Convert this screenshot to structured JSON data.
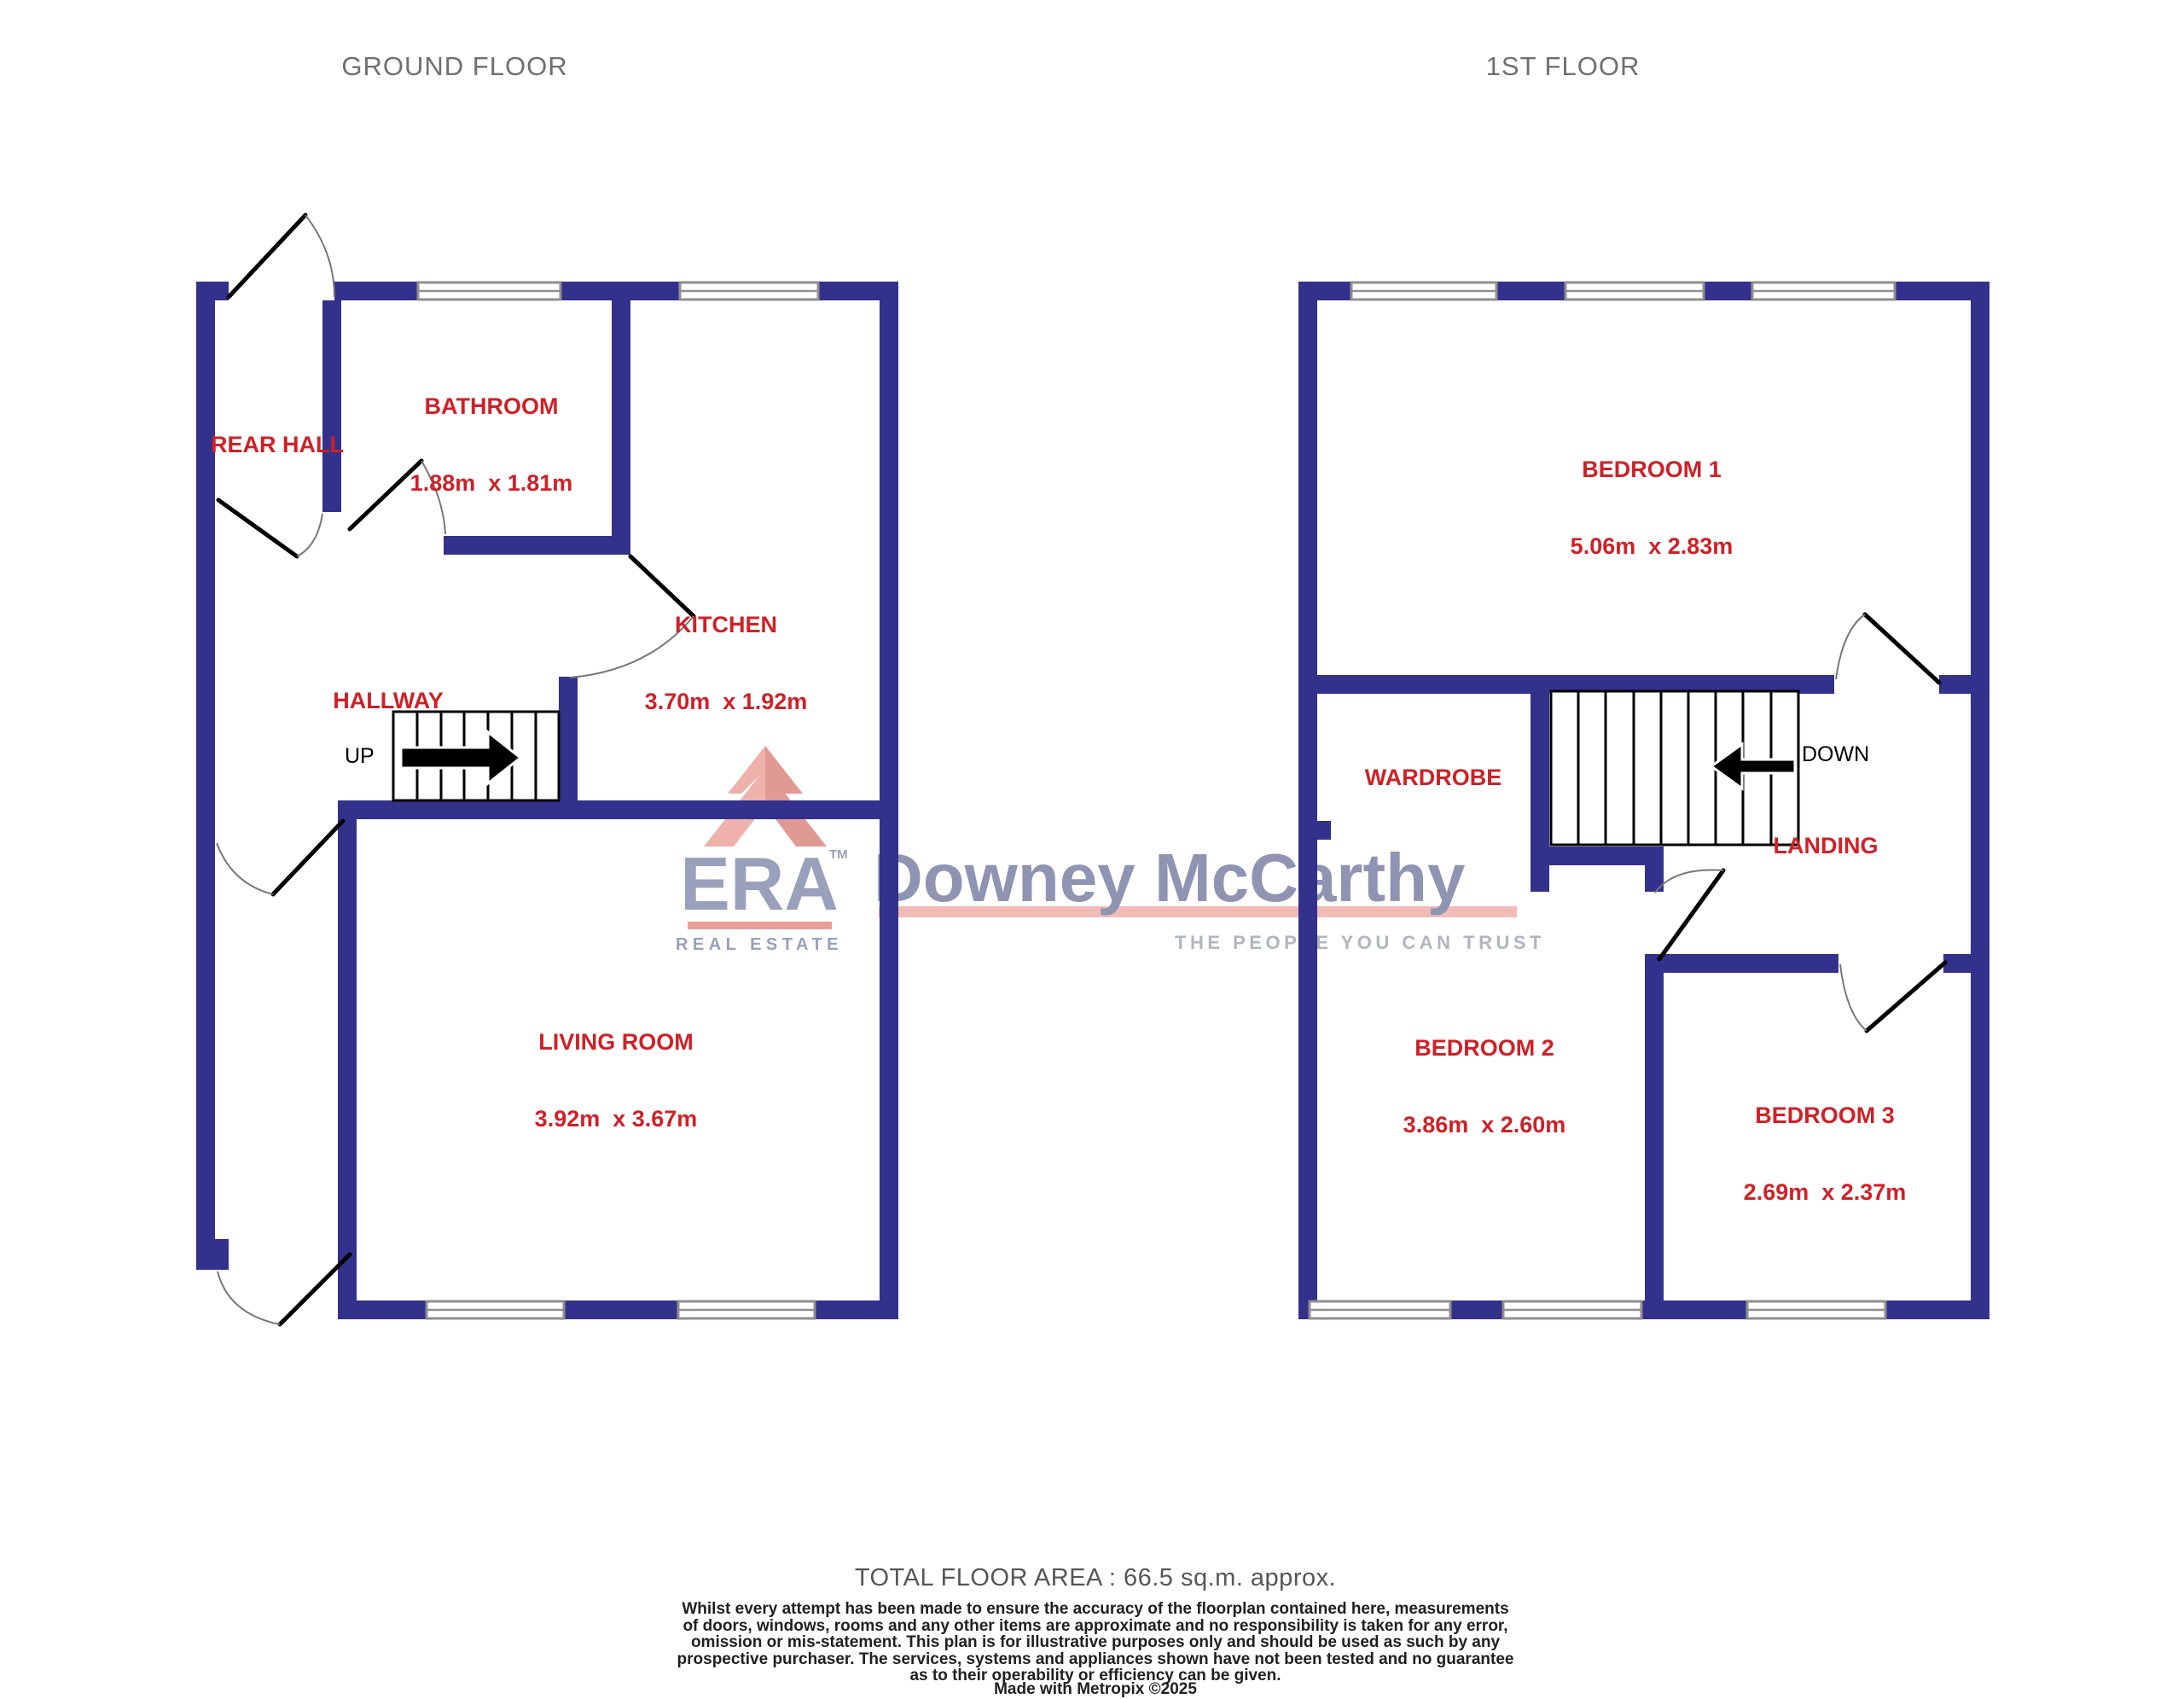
{
  "titles": {
    "ground_floor": "GROUND FLOOR",
    "first_floor": "1ST FLOOR"
  },
  "ground_floor": {
    "stairs_label": "UP",
    "rooms": [
      {
        "name": "REAR HALL",
        "dims": ""
      },
      {
        "name": "BATHROOM",
        "dims": "1.88m  x 1.81m"
      },
      {
        "name": "KITCHEN",
        "dims": "3.70m  x 1.92m"
      },
      {
        "name": "HALLWAY",
        "dims": ""
      },
      {
        "name": "LIVING ROOM",
        "dims": "3.92m  x 3.67m"
      }
    ]
  },
  "first_floor": {
    "stairs_label": "DOWN",
    "rooms": [
      {
        "name": "BEDROOM 1",
        "dims": "5.06m  x 2.83m"
      },
      {
        "name": "WARDROBE",
        "dims": ""
      },
      {
        "name": "LANDING",
        "dims": ""
      },
      {
        "name": "BEDROOM 2",
        "dims": "3.86m  x 2.60m"
      },
      {
        "name": "BEDROOM 3",
        "dims": "2.69m  x 2.37m"
      }
    ]
  },
  "logo": {
    "brand": "ERA",
    "tm": "TM",
    "brand_sub": "REAL ESTATE",
    "agency": "Downey McCarthy",
    "tagline": "THE PEOPLE YOU CAN TRUST"
  },
  "footer": {
    "total_area": "TOTAL FLOOR AREA : 66.5 sq.m. approx.",
    "disclaimer": "Whilst every attempt has been made to ensure the accuracy of the floorplan contained here, measurements\nof doors, windows, rooms and any other items are approximate and no responsibility is taken for any error,\nomission or mis-statement. This plan is for illustrative purposes only and should be used as such by any\nprospective purchaser. The services, systems and appliances shown have not been tested and no guarantee\nas to their operability or efficiency can be given.",
    "credit": "Made with Metropix ©2025"
  },
  "colors": {
    "wall": "#32318C",
    "label-red": "#CE2127",
    "title-gray": "#6F6F6F",
    "window-gray": "#8F8F8F",
    "arc-gray": "#777777",
    "logo-slate": "#7C86A8",
    "logo-slate2": "#6F779D",
    "logo-pink": "#F0A9A2",
    "logo-salmon": "#E4837C",
    "roof-light": "#EB9C94",
    "roof-dark": "#D97E76",
    "tagline-gray": "#9CA1AB",
    "footer-dark": "#1F1F1F",
    "footer-gray": "#565656"
  }
}
